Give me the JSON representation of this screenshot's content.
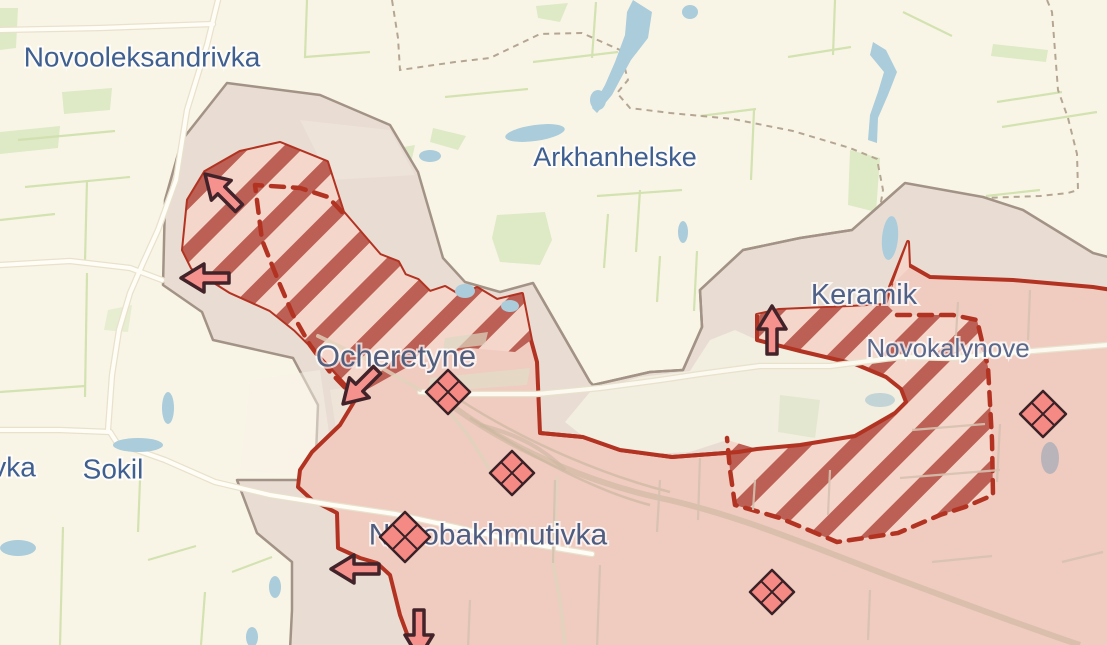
{
  "map": {
    "description": "Frontline situation map around Ocheretyne",
    "places": [
      {
        "id": "novooleksandrivka",
        "name": "Novooleksandrivka",
        "x": 142,
        "y": 57,
        "font_size": 28,
        "color": "#3e5f90"
      },
      {
        "id": "arkhanhelske",
        "name": "Arkhanhelske",
        "x": 615,
        "y": 157,
        "font_size": 27,
        "color": "#3e5f90"
      },
      {
        "id": "keramik",
        "name": "Keramik",
        "x": 864,
        "y": 295,
        "font_size": 29,
        "color": "#4e5f88"
      },
      {
        "id": "novokalynove",
        "name": "Novokalynove",
        "x": 948,
        "y": 348,
        "font_size": 26,
        "color": "#5a688c"
      },
      {
        "id": "ocheretyne",
        "name": "Ocheretyne",
        "x": 396,
        "y": 356,
        "font_size": 31,
        "color": "#515e7e"
      },
      {
        "id": "sokil",
        "name": "Sokil",
        "x": 113,
        "y": 469,
        "font_size": 28,
        "color": "#3e5f90"
      },
      {
        "id": "vka",
        "name": "vka",
        "x": 14,
        "y": 467,
        "font_size": 28,
        "color": "#3e5f90"
      },
      {
        "id": "novobakhmutivka",
        "name": "Novobakhmutivka",
        "x": 488,
        "y": 535,
        "font_size": 30,
        "color": "#4f5d80"
      }
    ],
    "markers": {
      "type": "battle-diamond",
      "fill": "#f58a84",
      "stroke": "#3a2127",
      "items": [
        {
          "x": 448,
          "y": 392,
          "size": 22
        },
        {
          "x": 512,
          "y": 473,
          "size": 22
        },
        {
          "x": 405,
          "y": 537,
          "size": 25
        },
        {
          "x": 772,
          "y": 592,
          "size": 22
        },
        {
          "x": 1043,
          "y": 414,
          "size": 23
        }
      ]
    },
    "arrows": {
      "fill": "#f5928e",
      "stroke": "#42232a",
      "items": [
        {
          "direction": "up-left",
          "x": 222,
          "y": 191,
          "angle": -135
        },
        {
          "direction": "left",
          "x": 205,
          "y": 278,
          "angle": 180
        },
        {
          "direction": "down-left",
          "x": 360,
          "y": 387,
          "angle": 135
        },
        {
          "direction": "up",
          "x": 772,
          "y": 330,
          "angle": -90
        },
        {
          "direction": "left",
          "x": 355,
          "y": 569,
          "angle": 180
        },
        {
          "direction": "down",
          "x": 419,
          "y": 634,
          "angle": 90
        }
      ]
    },
    "zones": {
      "occupied_fill": "#f0cbc0",
      "frontline_color": "#b23322",
      "advance_stripe": "#bc5f54",
      "advance_bg": "#f5d6cb",
      "advance_dash_color": "#b23322",
      "contested_fill": "#e9ddd3",
      "contested_border": "#a29386",
      "enclave_fill": "#f2eee0"
    },
    "terrain": {
      "background": "#f9f5e6",
      "water": "#abccdb",
      "field_line": "#cfe0ac",
      "green_patch": "#dee9c6",
      "road": "#fffdf6",
      "railway": "#ccb8a1",
      "admin_boundary_dash": "#b5a694"
    }
  }
}
